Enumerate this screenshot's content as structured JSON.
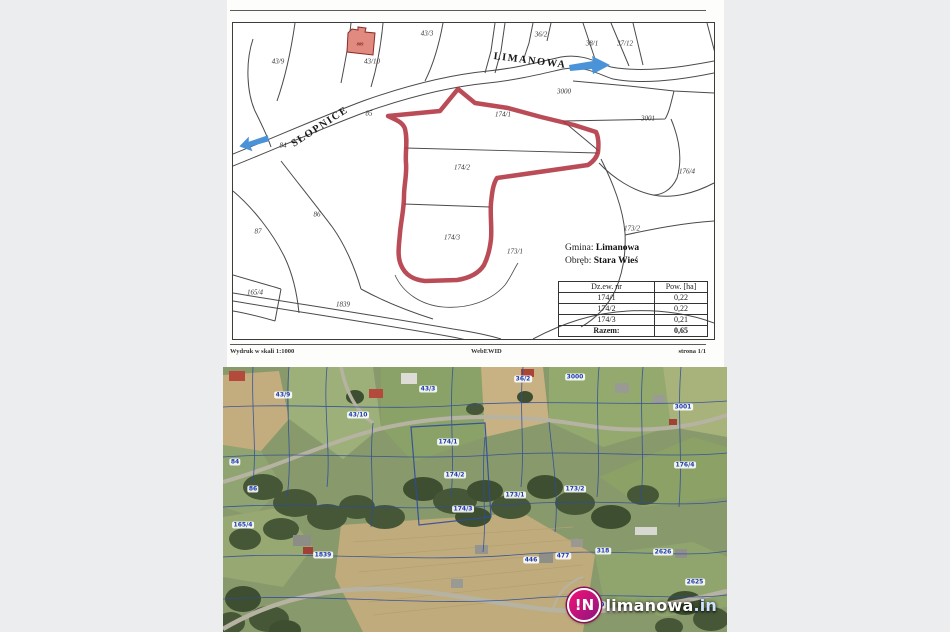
{
  "document": {
    "map": {
      "labels": [
        "43/9",
        "43/10",
        "43/3",
        "36/2",
        "38/1",
        "37/12",
        "3000",
        "3001",
        "176/4",
        "173/2",
        "173/1",
        "174/1",
        "174/2",
        "174/3",
        "84",
        "85",
        "86",
        "87",
        "165/4",
        "1839",
        "LIMANOWA",
        "SŁOPNICE",
        "809"
      ]
    },
    "info": {
      "gmina_label": "Gmina:",
      "gmina_value": "Limanowa",
      "obreb_label": "Obręb:",
      "obreb_value": "Stara Wieś"
    },
    "table": {
      "headers": [
        "Dz.ew. nr",
        "Pow. [ha]"
      ],
      "rows": [
        {
          "nr": "174/1",
          "pow": "0,22"
        },
        {
          "nr": "174/2",
          "pow": "0,22"
        },
        {
          "nr": "174/3",
          "pow": "0,21"
        }
      ],
      "total": {
        "nr": "Razem:",
        "pow": "0,65"
      }
    },
    "footer": {
      "left": "Wydruk w skali 1:1000",
      "center": "WebEWID",
      "right": "strona 1/1"
    }
  },
  "satellite": {
    "labels": [
      "43/9",
      "43/10",
      "43/3",
      "36/2",
      "3000",
      "3001",
      "174/1",
      "174/2",
      "174/3",
      "173/1",
      "173/2",
      "176/4",
      "86",
      "165/4",
      "1839",
      "446",
      "477",
      "318",
      "110",
      "2626",
      "2625",
      "84"
    ],
    "logo": {
      "badge": "!N",
      "name": "limanowa",
      "tld": ".in"
    }
  },
  "colors": {
    "parcel_outline_red": "#b03340",
    "direction_arrow_blue": "#4a93d9",
    "cadastral_line_blue": "#2d4c9c",
    "logo_magenta": "#c01377"
  }
}
